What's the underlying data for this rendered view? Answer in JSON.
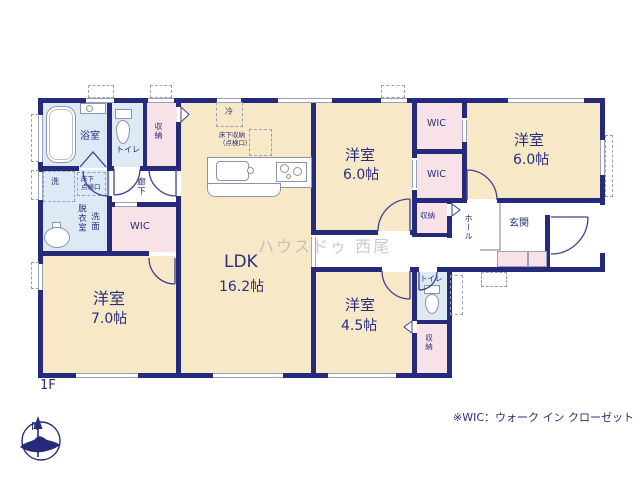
{
  "floor_plan": {
    "floor_label": "1F",
    "watermark": "ハウスドゥ 西尾",
    "note": "※WIC：ウォーク イン クローゼット",
    "compass": {
      "north_label": "N"
    },
    "rooms": {
      "bathroom": {
        "label": "浴室"
      },
      "toilet_upper": {
        "label": "トイレ"
      },
      "closet_upper": {
        "label": "収納"
      },
      "corridor": {
        "label": "廊下"
      },
      "dressing_room": {
        "label": "脱衣室"
      },
      "lavatory": {
        "label": "洗面"
      },
      "wic_west": {
        "label": "WIC"
      },
      "bedroom_west": {
        "label": "洋室",
        "size": "7.0帖"
      },
      "ldk": {
        "label": "LDK",
        "size": "16.2帖"
      },
      "bedroom_center": {
        "label": "洋室",
        "size": "6.0帖"
      },
      "wic_north": {
        "label": "WIC"
      },
      "wic_south": {
        "label": "WIC"
      },
      "bedroom_east": {
        "label": "洋室",
        "size": "6.0帖"
      },
      "closet_hall": {
        "label": "収納"
      },
      "hall": {
        "label": "ホール"
      },
      "entrance": {
        "label": "玄関"
      },
      "bedroom_south": {
        "label": "洋室",
        "size": "4.5帖"
      },
      "toilet_lower": {
        "label": "トイレ"
      },
      "closet_south": {
        "label": "収納"
      }
    },
    "fixtures": {
      "washing_machine": "洗",
      "refrigerator": "冷",
      "underfloor_storage_line1": "床下収納",
      "underfloor_storage_line2": "（点検口）",
      "underfloor_hatch_line1": "床下",
      "underfloor_hatch_line2": "点検口"
    }
  }
}
